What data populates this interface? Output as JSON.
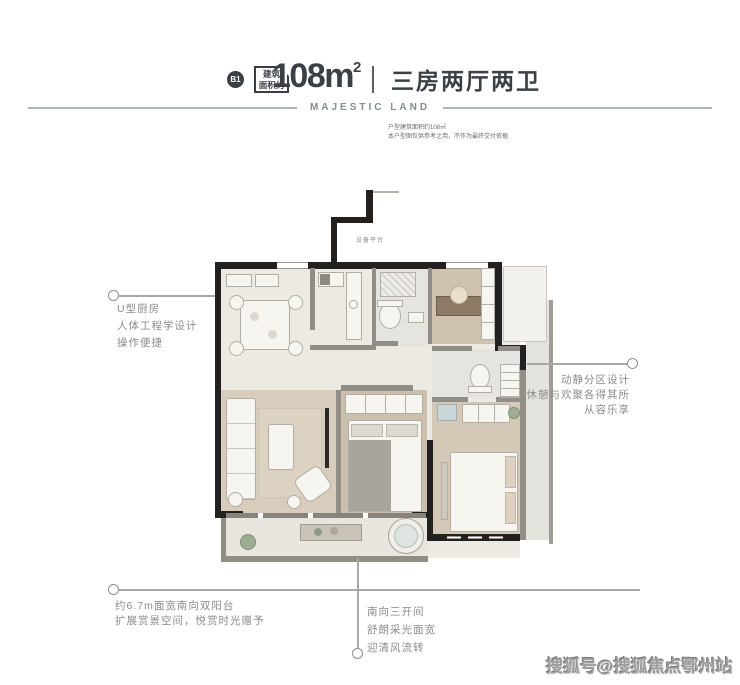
{
  "header": {
    "badge": "B1",
    "area_tag": {
      "line1": "建筑",
      "line2": "面积约"
    },
    "area": {
      "value": "108m",
      "superscript": "2"
    },
    "layout": "三房两厅两卫",
    "brand": "MAJESTIC LAND",
    "disclaimer": {
      "line1": "户型建筑面积约108㎡",
      "line2": "本户型图仅供参考之用，不作为最终交付依据"
    }
  },
  "floorplan": {
    "platform_label": "设备平台",
    "colors": {
      "wall": "#22211f",
      "partition": "#918e87",
      "floor_light": "#eceae3",
      "floor_wood": "#d4c8b6",
      "tile": "#e6e4e0"
    }
  },
  "callouts": {
    "kitchen": {
      "lines": [
        "U型厨房",
        "人体工程学设计",
        "操作便捷"
      ]
    },
    "zoning": {
      "lines": [
        "动静分区设计",
        "休憩与欢聚各得其所",
        "从容乐享"
      ]
    },
    "balcony": {
      "lines": [
        "约6.7m面宽南向双阳台",
        "扩展赏景空间，悦赏时光赠予"
      ]
    },
    "bays": {
      "lines": [
        "南向三开间",
        "舒朗采光面宽",
        "迎清风流转"
      ]
    }
  },
  "watermark": "搜狐号@搜狐焦点鄂州站"
}
